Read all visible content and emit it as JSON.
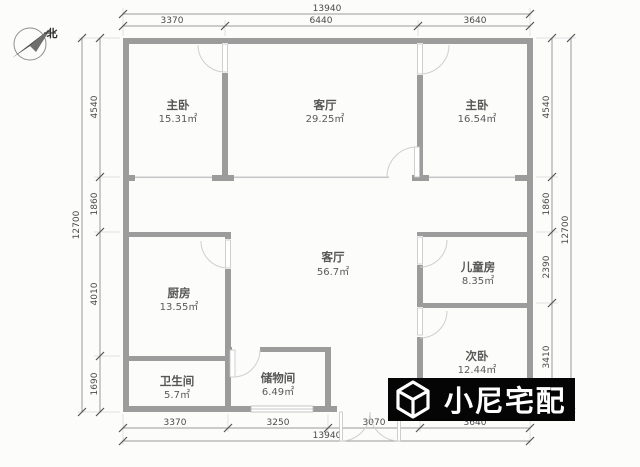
{
  "compass": {
    "label": "北"
  },
  "dimensions": {
    "top": {
      "overall": "13940",
      "segments": [
        "3370",
        "6440",
        "3640"
      ]
    },
    "bottom": {
      "overall": "13940",
      "segments": [
        "3370",
        "3250",
        "3070",
        "3640"
      ]
    },
    "left": {
      "overall": "12700",
      "segments": [
        "4540",
        "1860",
        "4010",
        "1690"
      ]
    },
    "right": {
      "overall": "12700",
      "segments": [
        "4540",
        "1860",
        "2390",
        "3410"
      ]
    }
  },
  "rooms": [
    {
      "name": "主卧",
      "area": "15.31㎡"
    },
    {
      "name": "客厅",
      "area": "29.25㎡"
    },
    {
      "name": "主卧",
      "area": "16.54㎡"
    },
    {
      "name": "客厅",
      "area": "56.7㎡"
    },
    {
      "name": "厨房",
      "area": "13.55㎡"
    },
    {
      "name": "儿童房",
      "area": "8.35㎡"
    },
    {
      "name": "次卧",
      "area": "12.44㎡"
    },
    {
      "name": "卫生间",
      "area": "5.7㎡"
    },
    {
      "name": "储物间",
      "area": "6.49㎡"
    }
  ],
  "watermark": {
    "brand": "小尼宅配",
    "icon": "cube-logo-icon"
  },
  "colors": {
    "wall": "#9c9c9c",
    "dimension_line": "#9a9a9a",
    "text": "#565656",
    "door_arc": "#cfcfcf",
    "watermark_bg": "#050505",
    "watermark_fg": "#ffffff",
    "background": "#fcfcfb"
  }
}
